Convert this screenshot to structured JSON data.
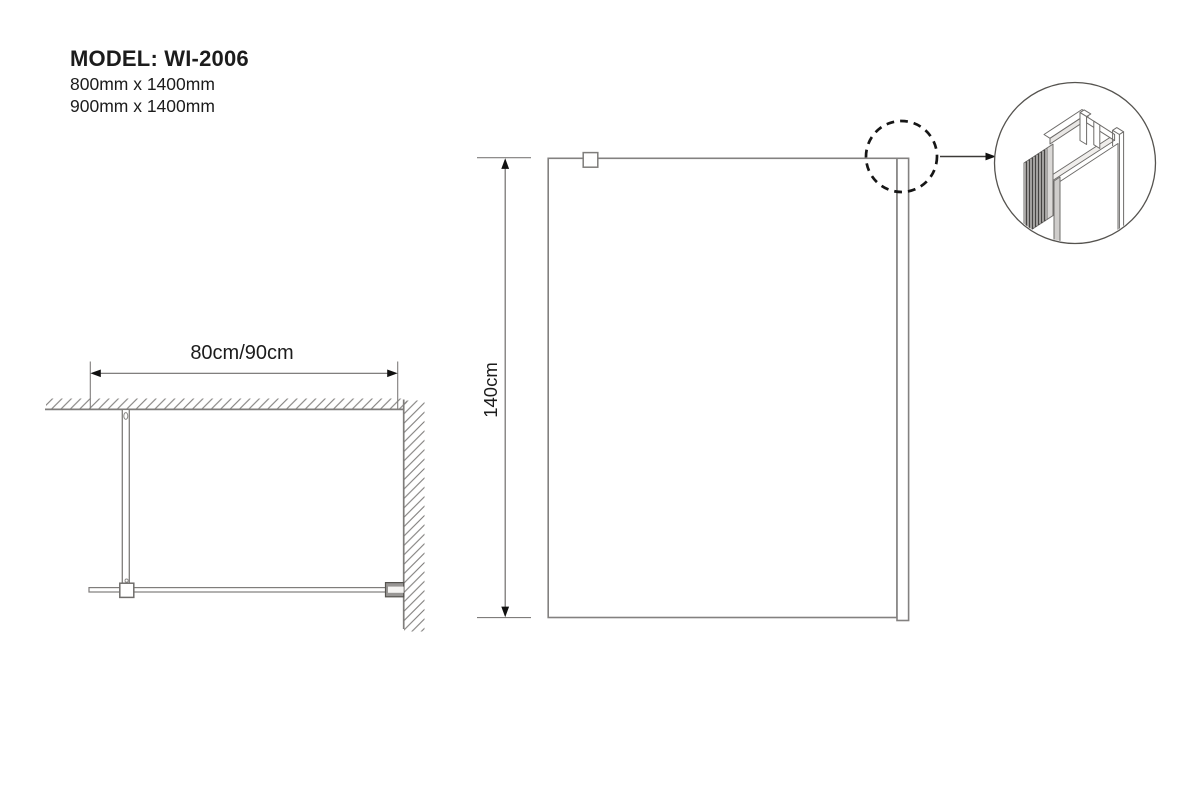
{
  "product": {
    "model_title": "MODEL: WI-2006",
    "size_option_1": "800mm x 1400mm",
    "size_option_2": "900mm x 1400mm"
  },
  "plan_view": {
    "width_dimension_label": "80cm/90cm"
  },
  "front_view": {
    "height_dimension_label": "140cm"
  },
  "colors": {
    "drawing_line_gray": "#7f7d7b",
    "text_ink": "#1c1c1c",
    "callout_black": "#161616"
  }
}
